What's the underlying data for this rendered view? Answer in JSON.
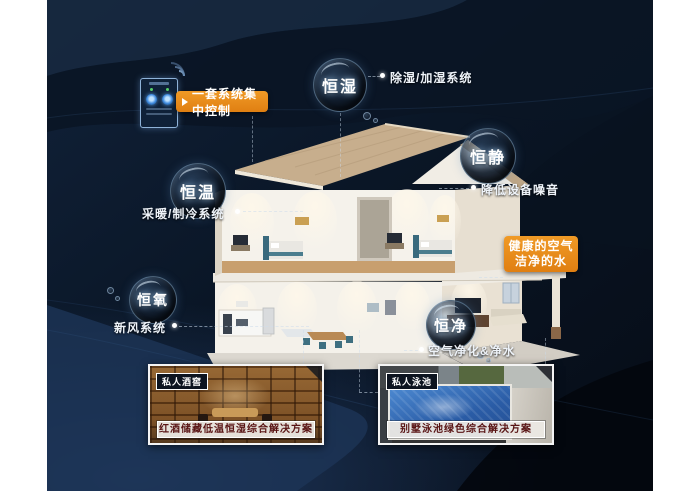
{
  "control_panel": {
    "label": "一套系统集中控制",
    "panel_icon": "smart-control-panel",
    "wifi_icon": "wifi-signal"
  },
  "features": [
    {
      "key": "humidity",
      "bubble": "恒湿",
      "desc": "除湿/加湿系统"
    },
    {
      "key": "temperature",
      "bubble": "恒温",
      "desc": "采暖/制冷系统"
    },
    {
      "key": "quiet",
      "bubble": "恒静",
      "desc": "降低设备噪音"
    },
    {
      "key": "oxygen",
      "bubble": "恒氧",
      "desc": "新风系统"
    },
    {
      "key": "purity",
      "bubble": "恒净",
      "desc": "空气净化&净水"
    }
  ],
  "highlight": {
    "line1": "健康的空气",
    "line2": "洁净的水"
  },
  "photos": [
    {
      "tag": "私人酒窖",
      "caption": "红酒储藏低温恒湿综合解决方案"
    },
    {
      "tag": "私人泳池",
      "caption": "别墅泳池绿色综合解决方案"
    }
  ],
  "colors": {
    "accent_orange": "#E5881A",
    "stage_navy": "#0C1A2C",
    "bottom_glow_navy": "#1D3456",
    "bubble_rim": "#96BEE1",
    "caption_red": "#591414",
    "roof_tan": "#C7AE8D",
    "pool_blue": "#2A5CA6"
  }
}
